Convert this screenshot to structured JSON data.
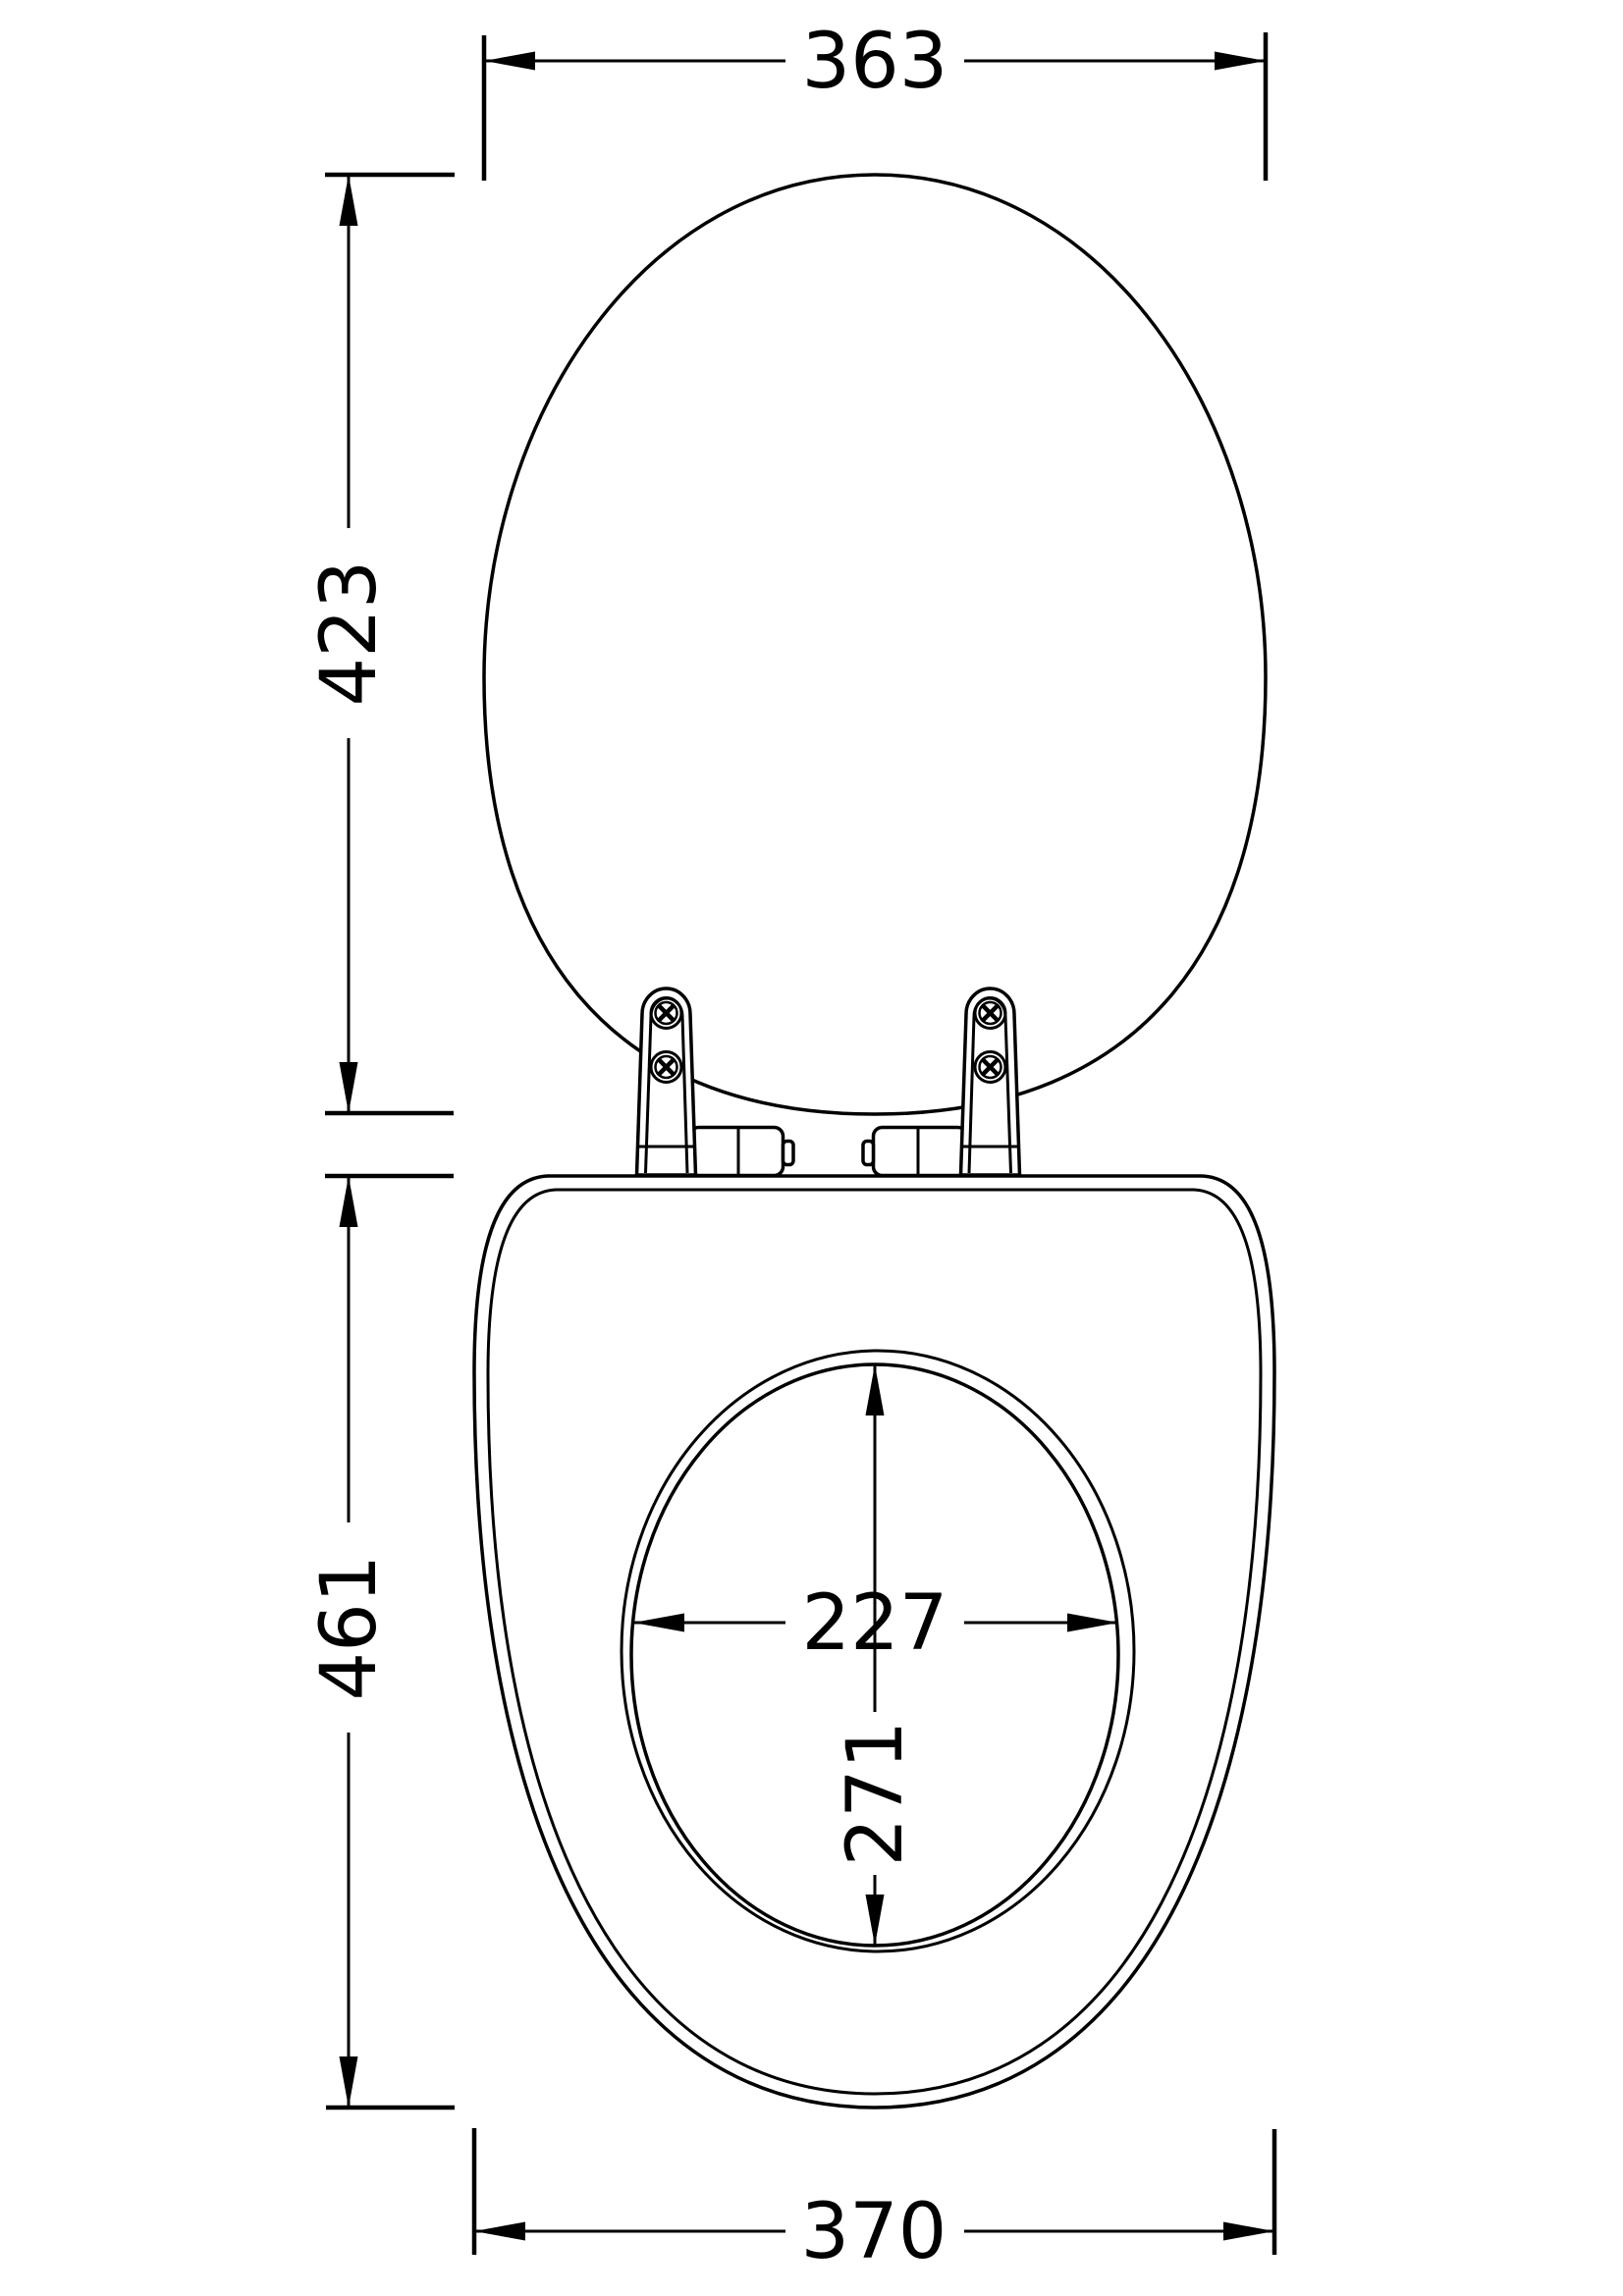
{
  "drawing": {
    "title": "toilet-seat-and-lid-dimension-drawing",
    "background_color": "#ffffff",
    "line_color": "#000000"
  },
  "dimensions": {
    "lid_width": {
      "value": "363",
      "orientation": "horizontal",
      "location": "top"
    },
    "lid_height": {
      "value": "423",
      "orientation": "vertical",
      "location": "left-upper"
    },
    "seat_height": {
      "value": "461",
      "orientation": "vertical",
      "location": "left-lower"
    },
    "seat_width": {
      "value": "370",
      "orientation": "horizontal",
      "location": "bottom"
    },
    "opening_width": {
      "value": "227",
      "orientation": "horizontal",
      "location": "center-of-opening"
    },
    "opening_height": {
      "value": "271",
      "orientation": "vertical",
      "location": "center-of-opening"
    }
  },
  "parts": {
    "lid": "toilet-seat-lid-top-view",
    "seat": "toilet-seat-ring-top-view",
    "opening": "seat-inner-opening",
    "hinges": "two-hinge-plates-with-phillips-screws-and-barrels"
  }
}
